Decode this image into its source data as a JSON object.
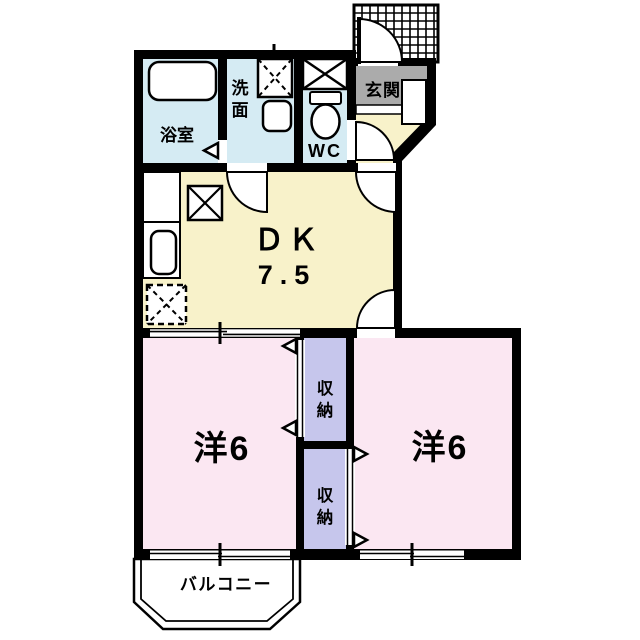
{
  "colors": {
    "wall": "#000000",
    "water_room": "#d5ebf3",
    "dk": "#f8f2ca",
    "bedroom": "#fbe7f2",
    "closet": "#c6c6ec",
    "entrance_gray": "#ababab",
    "white": "#ffffff"
  },
  "rooms": {
    "bathroom": {
      "label": "浴室"
    },
    "washroom": {
      "label": "洗面",
      "chars": [
        "洗",
        "面"
      ]
    },
    "wc": {
      "label": "WC"
    },
    "entrance": {
      "label": "玄関"
    },
    "dk": {
      "name": "ＤＫ",
      "size": "7.5"
    },
    "bedroom_left": {
      "label": "洋6"
    },
    "bedroom_right": {
      "label": "洋6"
    },
    "closet_upper": {
      "label": "収納",
      "chars": [
        "収",
        "納"
      ]
    },
    "closet_lower": {
      "label": "収納",
      "chars": [
        "収",
        "納"
      ]
    },
    "balcony": {
      "label": "バルコニー"
    }
  }
}
